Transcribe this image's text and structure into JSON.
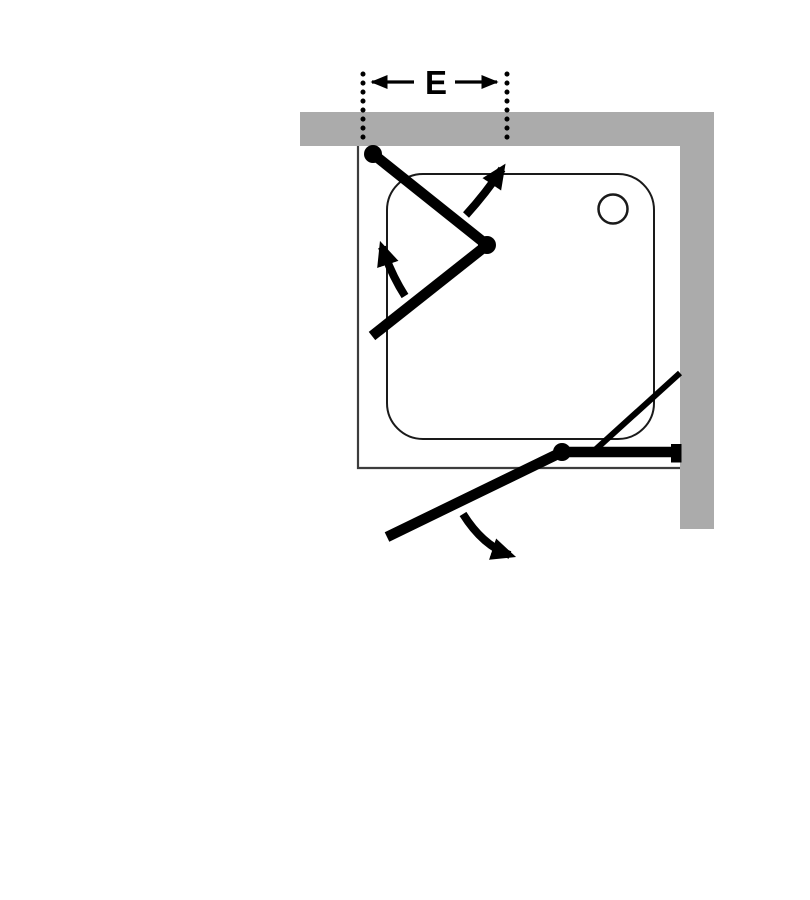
{
  "diagram": {
    "kind": "corner-shower-enclosure-top-view",
    "dimension": {
      "label": "E"
    }
  },
  "colors": {
    "wall": "#ABABAB",
    "line": "#000000",
    "outline": "#3D3D3D",
    "tray": "#1A1A1A",
    "background": "#FFFFFF"
  }
}
